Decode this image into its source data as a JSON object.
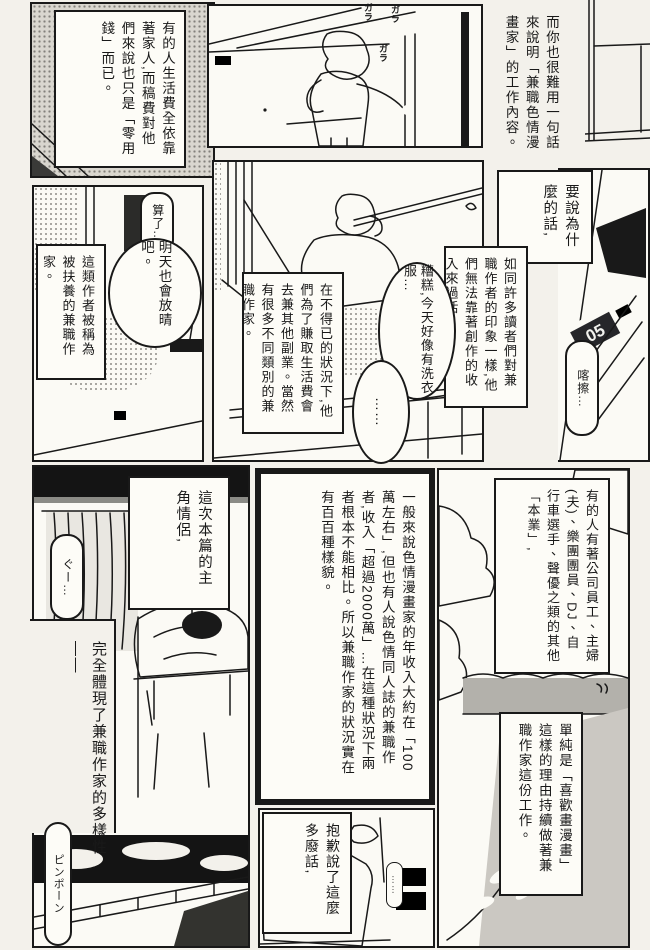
{
  "palette": {
    "ink": "#191919",
    "paper": "#f3f1eb",
    "tone_gray": "#b3b1ab",
    "night_black": "#141414"
  },
  "captions": {
    "allowance": "有的人生活費全依靠著家人,而稿費對他們來說也只是「零用錢」而已。",
    "hard_to_explain": "而你也很難用一句話來說明「兼職色情漫畫家」的工作內容。",
    "why": "要說為什麼的話,",
    "readers_impression": "如同許多讀者們對兼職作者的印象一樣,他們無法靠著創作的收入來過活,",
    "dependent": "這類作者被稱為被扶養的兼職作家。",
    "side_jobs": "在不得已的狀況下,他們為了賺取生活費會去兼其他副業。當然有很多不同類別的兼職作家。",
    "protagonists": "這次本篇的主角情侶,",
    "embody": "完全體現了兼職作家的多樣性——",
    "income": "一般來說色情漫畫家的年收入大約在「100萬左右」,但也有人說色情同人誌的兼職作者,收入「超過2000萬」…在這種狀況下兩者根本不能相比。所以兼職作家的狀況實在有百百種樣貌。",
    "other_jobs": "有的人有著公司員工、主婦(夫)、樂團團員、DJ、自行車選手、聲優之類的其他「本業」,",
    "reason": "單純是「喜歡畫漫畫」這樣的理由持續做著兼職作家這份工作。",
    "apology": "抱歉說了這麼多廢話,"
  },
  "speech": {
    "oh_well": "算了…",
    "sunny_tomorrow": "明天也會放晴吧。",
    "laundry": "糟糕,今天好像有洗衣服…",
    "dots": "……",
    "tiny_dots": "……"
  },
  "sfx": {
    "slide_door": "ガラ",
    "click": "喀擦…",
    "snore": "ぐー…",
    "doorbell": "ピンポーン"
  },
  "art": {
    "clock_display": "05"
  }
}
